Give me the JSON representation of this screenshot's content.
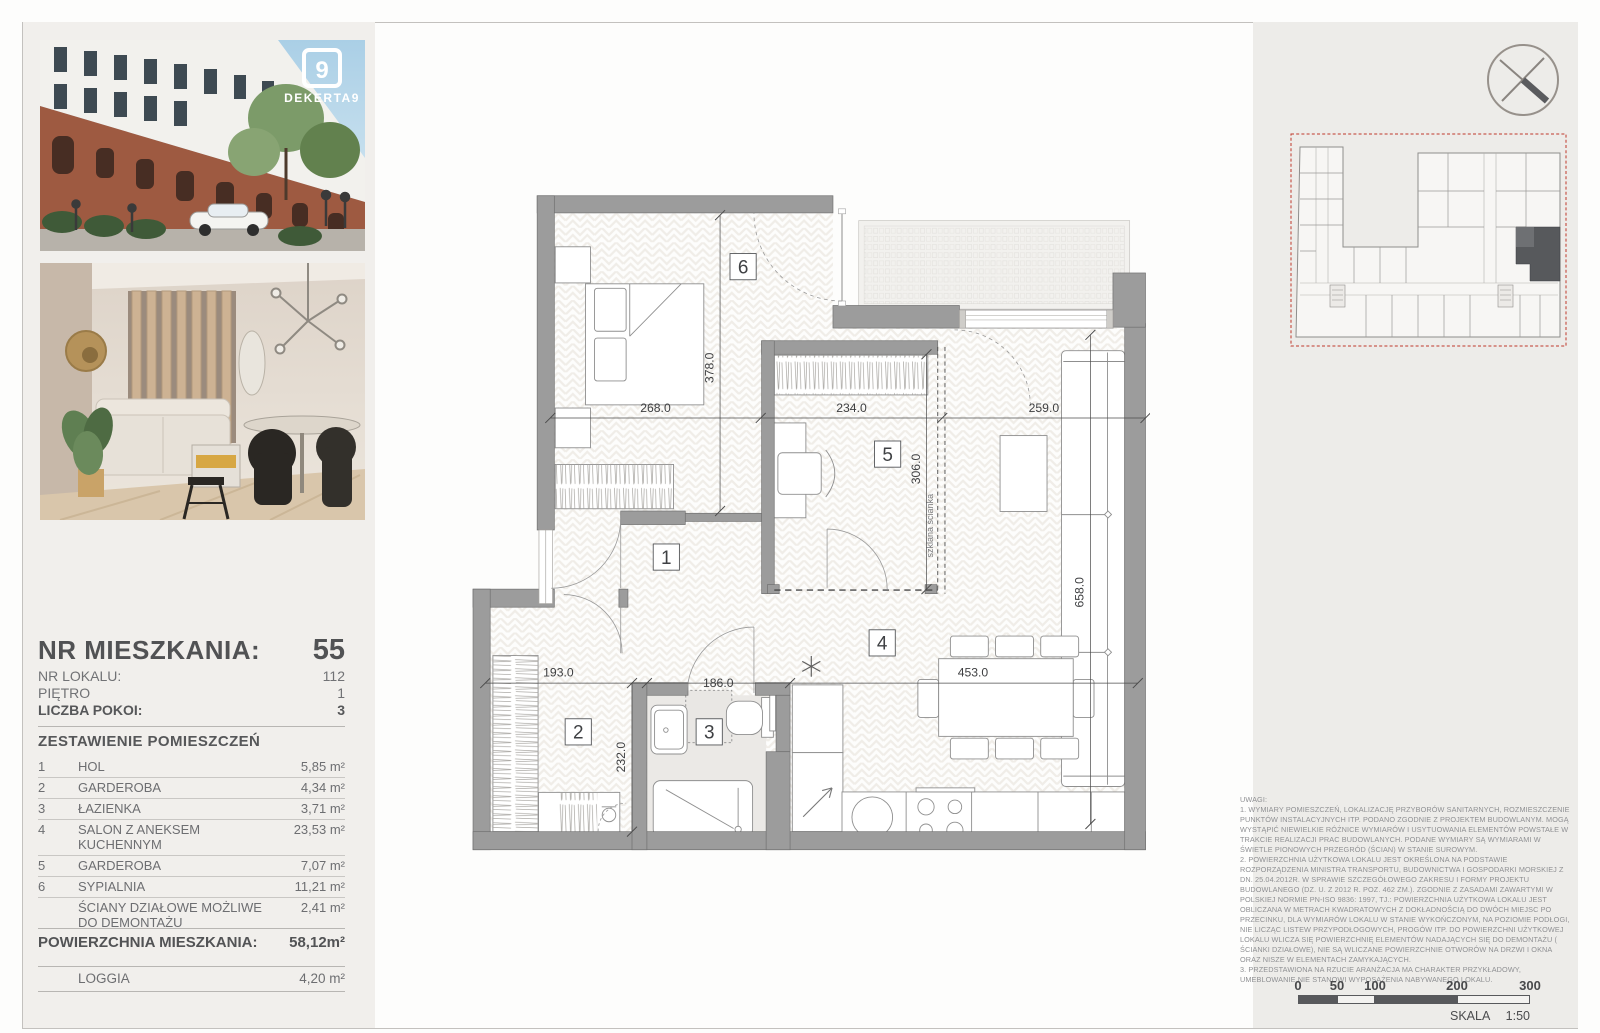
{
  "header": {
    "brand": "DEKERTA9",
    "logo_short": "9"
  },
  "info": {
    "nr_mieszkania_label": "NR MIESZKANIA:",
    "nr_mieszkania_value": "55",
    "nr_lokalu_label": "NR LOKALU:",
    "nr_lokalu_value": "112",
    "pietro_label": "PIĘTRO",
    "pietro_value": "1",
    "liczba_pokoi_label": "LICZBA POKOI:",
    "liczba_pokoi_value": "3",
    "rooms_title": "ZESTAWIENIE POMIESZCZEŃ",
    "rooms": [
      {
        "no": "1",
        "name": "HOL",
        "area": "5,85 m²"
      },
      {
        "no": "2",
        "name": "GARDEROBA",
        "area": "4,34 m²"
      },
      {
        "no": "3",
        "name": "ŁAZIENKA",
        "area": "3,71 m²"
      },
      {
        "no": "4",
        "name": "SALON Z ANEKSEM KUCHENNYM",
        "area": "23,53 m²"
      },
      {
        "no": "5",
        "name": "GARDEROBA",
        "area": "7,07 m²"
      },
      {
        "no": "6",
        "name": "SYPIALNIA",
        "area": "11,21 m²"
      },
      {
        "no": "",
        "name": "ŚCIANY DZIAŁOWE MOŻLIWE DO DEMONTAŻU",
        "area": "2,41 m²"
      }
    ],
    "total_label": "POWIERZCHNIA MIESZKANIA:",
    "total_value": "58,12m²",
    "loggia_label": "LOGGIA",
    "loggia_value": "4,20 m²"
  },
  "plan": {
    "dims": {
      "d268": "268.0",
      "d234": "234.0",
      "d259": "259.0",
      "d378": "378.0",
      "d306": "306.0",
      "d658": "658.0",
      "d193": "193.0",
      "d186": "186.0",
      "d453": "453.0",
      "d232": "232.0"
    },
    "room_numbers": {
      "r1": "1",
      "r2": "2",
      "r3": "3",
      "r4": "4",
      "r5": "5",
      "r6": "6"
    },
    "glass_wall_label": "szklana ścianka"
  },
  "notes": {
    "title": "UWAGI:",
    "items": [
      "1. WYMIARY POMIESZCZEŃ, LOKALIZACJĘ PRZYBORÓW SANITARNYCH, ROZMIESZCZENIE PUNKTÓW INSTALACYJNYCH ITP. PODANO ZGODNIE Z PROJEKTEM BUDOWLANYM. MOGĄ WYSTĄPIĆ NIEWIELKIE RÓŻNICE WYMIARÓW I USYTUOWANIA ELEMENTÓW POWSTAŁE W TRAKCIE REALIZACJI PRAC BUDOWLANYCH. PODANE WYMIARY SĄ WYMIARAMI W ŚWIETLE PIONOWYCH PRZEGRÓD (ŚCIAN) W STANIE SUROWYM.",
      "2. POWIERZCHNIA UŻYTKOWA LOKALU JEST OKREŚLONA NA PODSTAWIE ROZPORZĄDZENIA MINISTRA TRANSPORTU, BUDOWNICTWA I GOSPODARKI MORSKIEJ Z DN. 25.04.2012R. W SPRAWIE SZCZEGÓŁOWEGO ZAKRESU I FORMY PROJEKTU BUDOWLANEGO (DZ. U. Z 2012 R. POZ. 462 ZM.). ZGODNIE Z ZASADAMI ZAWARTYMI W POLSKIEJ NORMIE PN-ISO 9836: 1997, TJ.: POWIERZCHNIA UŻYTKOWA LOKALU JEST OBLICZANA W METRACH KWADRATOWYCH Z DOKŁADNOŚCIĄ DO DWÓCH MIEJSC PO PRZECINKU, DLA WYMIARÓW LOKALU W STANIE WYKOŃCZONYM, NA POZIOMIE PODŁOGI, NIE LICZĄC LISTEW PRZYPODŁOGOWYCH, PROGÓW ITP. DO POWIERZCHNI UŻYTKOWEJ LOKALU WLICZA SIĘ POWIERZCHNIĘ ELEMENTÓW NADAJĄCYCH SIĘ DO DEMONTAŻU ( ŚCIANKI DZIAŁOWE), NIE SĄ WLICZANE POWIERZCHNIE OTWORÓW NA DRZWI I OKNA ORAZ NISZE W ELEMENTACH ZAMYKAJĄCYCH.",
      "3. PRZEDSTAWIONA NA RZUCIE ARANŻACJA MA CHARAKTER PRZYKŁADOWY, UMEBLOWANIE NIE STANOWI WYPOSAŻENIA NABYWANEGO LOKALU."
    ]
  },
  "scalebar": {
    "ticks": [
      "0",
      "50",
      "100",
      "200",
      "300"
    ],
    "skala_label": "SKALA",
    "skala_value": "1:50"
  },
  "colors": {
    "wall": "#9c9c9c",
    "accent_red": "#c0392b",
    "panel": "#f1efec",
    "ink": "#515254"
  }
}
